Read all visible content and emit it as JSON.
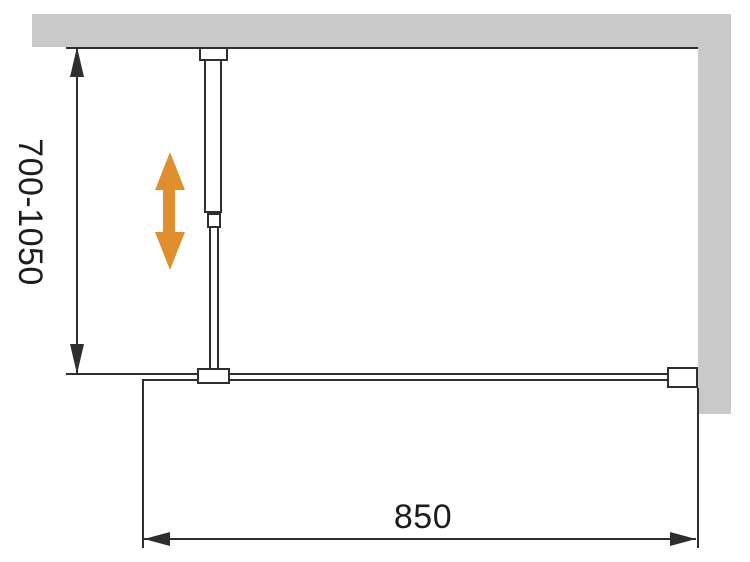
{
  "diagram": {
    "labels": {
      "height_range": "700-1050",
      "width": "850"
    },
    "colors": {
      "wall_gray": "#C9C9C9",
      "line_dark": "#2E2E2E",
      "text_dark": "#1C1C1C",
      "accent_orange": "#E08E2E",
      "background": "#FFFFFF"
    }
  }
}
